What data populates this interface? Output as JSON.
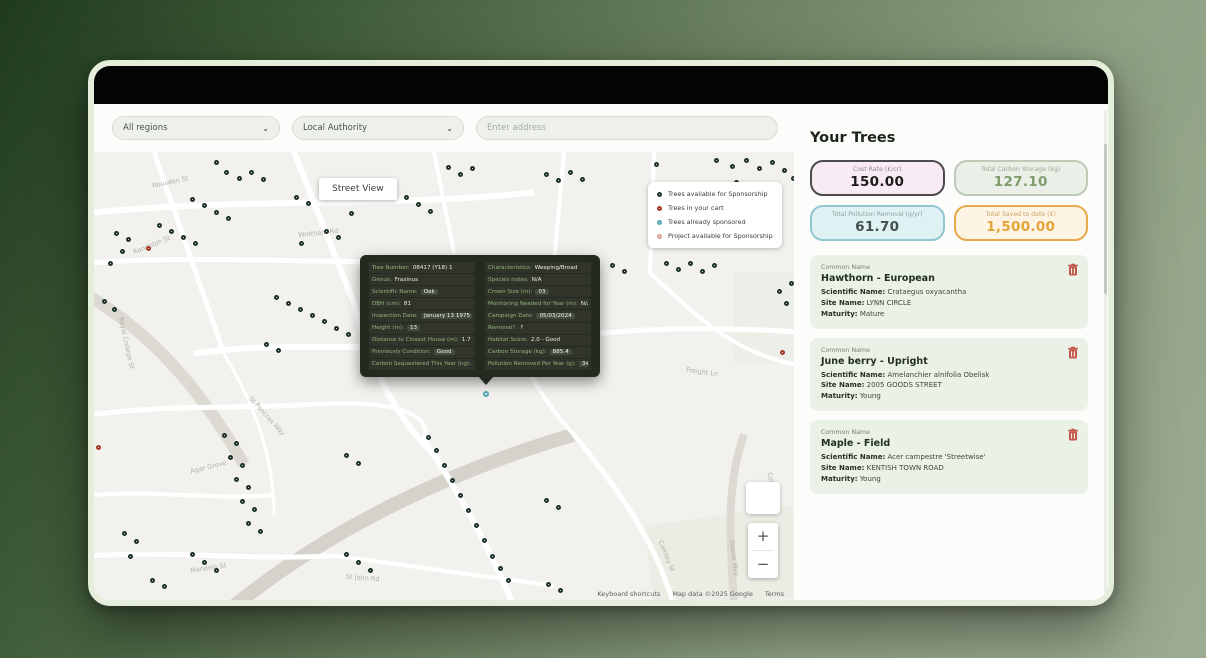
{
  "filters": {
    "region_value": "All regions",
    "authority_value": "Local Authority",
    "address_placeholder": "Enter address",
    "chevron": "⌄"
  },
  "map": {
    "street_view_label": "Street View",
    "zoom_in": "+",
    "zoom_out": "−",
    "attribution": {
      "shortcuts": "Keyboard shortcuts",
      "copyright": "Map data ©2025 Google",
      "terms": "Terms"
    },
    "legend": [
      {
        "label": "Trees available for Sponsorship",
        "color": "#1f3329"
      },
      {
        "label": "Trees in your cart",
        "color": "#a33a28"
      },
      {
        "label": "Trees already sponsored",
        "color": "#55a9b7"
      },
      {
        "label": "Project available for Sponsorship",
        "color": "#dba49b"
      }
    ],
    "street_labels": [
      {
        "t": "Rousden St",
        "x": 58,
        "y": 26,
        "r": -12
      },
      {
        "t": "Randolph St",
        "x": 38,
        "y": 88,
        "r": -22
      },
      {
        "t": "Wrotham Rd",
        "x": 204,
        "y": 76,
        "r": -6
      },
      {
        "t": "Busby St",
        "x": 284,
        "y": 172,
        "r": -10
      },
      {
        "t": "Royal College St",
        "x": 6,
        "y": 185,
        "r": 78
      },
      {
        "t": "Camden Mews",
        "x": 314,
        "y": 192,
        "r": -5
      },
      {
        "t": "Freight Ln",
        "x": 592,
        "y": 214,
        "r": 8
      },
      {
        "t": "St Pancras Way",
        "x": 148,
        "y": 258,
        "r": 48
      },
      {
        "t": "Agar Grove",
        "x": 96,
        "y": 308,
        "r": -14
      },
      {
        "t": "Mandela St",
        "x": 96,
        "y": 408,
        "r": -8
      },
      {
        "t": "Goods Way",
        "x": 622,
        "y": 398,
        "r": 82
      },
      {
        "t": "College La",
        "x": 662,
        "y": 330,
        "r": 78
      },
      {
        "t": "Camley St",
        "x": 556,
        "y": 396,
        "r": 68
      },
      {
        "t": "St John Rd",
        "x": 252,
        "y": 418,
        "r": 4
      }
    ],
    "markers": [
      [
        130,
        18,
        "g"
      ],
      [
        143,
        24,
        "g"
      ],
      [
        155,
        18,
        "g"
      ],
      [
        167,
        25,
        "g"
      ],
      [
        120,
        8,
        "g"
      ],
      [
        352,
        13,
        "g"
      ],
      [
        364,
        20,
        "g"
      ],
      [
        376,
        14,
        "g"
      ],
      [
        450,
        20,
        "g"
      ],
      [
        462,
        26,
        "g"
      ],
      [
        474,
        18,
        "g"
      ],
      [
        486,
        25,
        "g"
      ],
      [
        560,
        10,
        "g"
      ],
      [
        620,
        6,
        "g"
      ],
      [
        636,
        12,
        "g"
      ],
      [
        650,
        6,
        "g"
      ],
      [
        663,
        14,
        "g"
      ],
      [
        676,
        8,
        "g"
      ],
      [
        688,
        16,
        "g"
      ],
      [
        640,
        28,
        "g"
      ],
      [
        610,
        33,
        "g"
      ],
      [
        697,
        24,
        "g"
      ],
      [
        96,
        45,
        "g"
      ],
      [
        108,
        51,
        "g"
      ],
      [
        120,
        57,
        "g"
      ],
      [
        132,
        63,
        "g"
      ],
      [
        200,
        43,
        "g"
      ],
      [
        212,
        49,
        "g"
      ],
      [
        255,
        58,
        "g"
      ],
      [
        310,
        43,
        "g"
      ],
      [
        322,
        50,
        "g"
      ],
      [
        334,
        56,
        "g"
      ],
      [
        75,
        76,
        "g"
      ],
      [
        87,
        82,
        "g"
      ],
      [
        99,
        88,
        "g"
      ],
      [
        63,
        70,
        "g"
      ],
      [
        230,
        76,
        "g"
      ],
      [
        242,
        82,
        "g"
      ],
      [
        205,
        88,
        "g"
      ],
      [
        52,
        93,
        "r"
      ],
      [
        20,
        78,
        "g"
      ],
      [
        32,
        84,
        "g"
      ],
      [
        26,
        96,
        "g"
      ],
      [
        14,
        108,
        "g"
      ],
      [
        8,
        146,
        "g"
      ],
      [
        18,
        154,
        "g"
      ],
      [
        192,
        148,
        "g"
      ],
      [
        204,
        154,
        "g"
      ],
      [
        216,
        160,
        "g"
      ],
      [
        228,
        166,
        "g"
      ],
      [
        180,
        142,
        "g"
      ],
      [
        240,
        172,
        "g"
      ],
      [
        252,
        178,
        "g"
      ],
      [
        170,
        188,
        "g"
      ],
      [
        182,
        194,
        "g"
      ],
      [
        516,
        110,
        "g"
      ],
      [
        528,
        116,
        "g"
      ],
      [
        570,
        108,
        "g"
      ],
      [
        582,
        114,
        "g"
      ],
      [
        594,
        108,
        "g"
      ],
      [
        606,
        116,
        "g"
      ],
      [
        618,
        110,
        "g"
      ],
      [
        695,
        128,
        "g"
      ],
      [
        683,
        136,
        "g"
      ],
      [
        690,
        148,
        "g"
      ],
      [
        686,
        196,
        "r"
      ],
      [
        2,
        290,
        "r"
      ],
      [
        128,
        278,
        "g"
      ],
      [
        140,
        286,
        "g"
      ],
      [
        134,
        300,
        "g"
      ],
      [
        146,
        308,
        "g"
      ],
      [
        140,
        322,
        "g"
      ],
      [
        152,
        330,
        "g"
      ],
      [
        146,
        344,
        "g"
      ],
      [
        158,
        352,
        "g"
      ],
      [
        152,
        366,
        "g"
      ],
      [
        164,
        374,
        "g"
      ],
      [
        332,
        280,
        "g"
      ],
      [
        340,
        293,
        "g"
      ],
      [
        348,
        308,
        "g"
      ],
      [
        356,
        323,
        "g"
      ],
      [
        364,
        338,
        "g"
      ],
      [
        372,
        353,
        "g"
      ],
      [
        380,
        368,
        "g"
      ],
      [
        388,
        383,
        "g"
      ],
      [
        396,
        398,
        "g"
      ],
      [
        404,
        410,
        "g"
      ],
      [
        412,
        422,
        "g"
      ],
      [
        250,
        298,
        "g"
      ],
      [
        262,
        306,
        "g"
      ],
      [
        450,
        343,
        "g"
      ],
      [
        462,
        350,
        "g"
      ],
      [
        28,
        376,
        "g"
      ],
      [
        40,
        384,
        "g"
      ],
      [
        34,
        398,
        "g"
      ],
      [
        96,
        396,
        "g"
      ],
      [
        108,
        404,
        "g"
      ],
      [
        120,
        412,
        "g"
      ],
      [
        56,
        422,
        "g"
      ],
      [
        68,
        428,
        "g"
      ],
      [
        250,
        396,
        "g"
      ],
      [
        262,
        404,
        "g"
      ],
      [
        274,
        412,
        "g"
      ],
      [
        452,
        426,
        "g"
      ],
      [
        464,
        432,
        "g"
      ],
      [
        389,
        237,
        "t"
      ]
    ]
  },
  "tooltip": {
    "left": [
      {
        "l": "Tree Number:",
        "v": "08417 (Y18) 1",
        "c": 0
      },
      {
        "l": "Genus:",
        "v": "Fraxinus",
        "c": 0
      },
      {
        "l": "Scientific Name:",
        "v": "Oak",
        "c": 1
      },
      {
        "l": "DBH (cm):",
        "v": "81",
        "c": 0
      },
      {
        "l": "Inspection Date:",
        "v": "January 13 1975",
        "c": 1
      },
      {
        "l": "Height (m):",
        "v": "13",
        "c": 1
      },
      {
        "l": "Distance to Closest House (m):",
        "v": "1.7",
        "c": 0
      },
      {
        "l": "Previously Condition:",
        "v": "Good",
        "c": 1
      },
      {
        "l": "Carbon Sequestered This Year (kg):",
        "v": "7.7",
        "c": 0
      }
    ],
    "right": [
      {
        "l": "Characteristics:",
        "v": "Weeping/Broad",
        "c": 0
      },
      {
        "l": "Species notes:",
        "v": "N/A",
        "c": 0
      },
      {
        "l": "Crown Size (m):",
        "v": "03",
        "c": 1
      },
      {
        "l": "Monitoring Needed for Year (m):",
        "v": "N/A",
        "c": 0
      },
      {
        "l": "Campaign Date:",
        "v": "05/03/2024",
        "c": 1
      },
      {
        "l": "Removal?:",
        "v": "?",
        "c": 0
      },
      {
        "l": "Habitat Score:",
        "v": "2.0 - Good",
        "c": 0
      },
      {
        "l": "Carbon Storage (kg):",
        "v": "885.4",
        "c": 1
      },
      {
        "l": "Pollution Removed Per Year (g):",
        "v": "348.3",
        "c": 1
      }
    ]
  },
  "sidebar": {
    "title": "Your Trees",
    "stats": [
      {
        "label": "Cost Rate (£/cr)",
        "value": "150.00",
        "bg": "#f9ebf4",
        "border": "#4b4b4b",
        "vcolor": "#1c1c1c",
        "lcolor": "#8a8a8a"
      },
      {
        "label": "Total Carbon Storage (kg)",
        "value": "127.10",
        "bg": "#eaf0e7",
        "border": "#bccab6",
        "vcolor": "#7e9c6c",
        "lcolor": "#98a791"
      },
      {
        "label": "Total Pollution Removal (g/yr)",
        "value": "61.70",
        "bg": "#e0f1f3",
        "border": "#8fc8d1",
        "vcolor": "#41514f",
        "lcolor": "#8da3a1"
      },
      {
        "label": "Total Saved to date (£)",
        "value": "1,500.00",
        "bg": "#fdf4e3",
        "border": "#e7a94b",
        "vcolor": "#e5a339",
        "lcolor": "#c9a26a"
      }
    ],
    "tree_field_labels": {
      "common": "Common Name",
      "scientific": "Scientific Name:",
      "site": "Site Name:",
      "maturity": "Maturity:"
    },
    "trees": [
      {
        "name": "Hawthorn - European",
        "scientific": "Crataegus oxyacantha",
        "site": "LYNN CIRCLE",
        "maturity": "Mature"
      },
      {
        "name": "June berry - Upright",
        "scientific": "Amelanchier alnifolia Obelisk",
        "site": "2005 GOODS STREET",
        "maturity": "Young"
      },
      {
        "name": "Maple - Field",
        "scientific": "Acer campestre 'Streetwise'",
        "site": "KENTISH TOWN ROAD",
        "maturity": "Young"
      }
    ]
  }
}
